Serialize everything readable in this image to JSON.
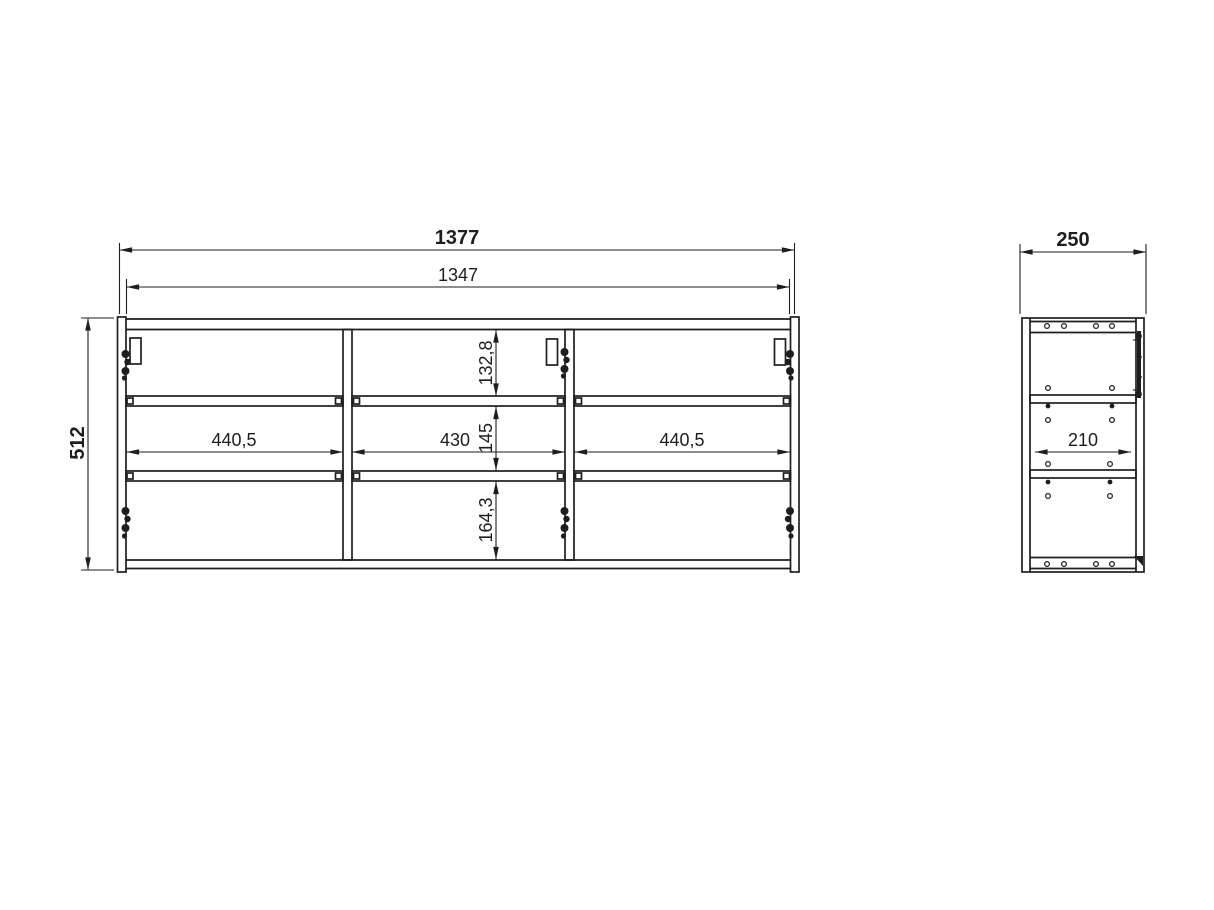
{
  "drawing": {
    "title": "cabinet-dimension-drawing",
    "colors": {
      "line": "#1e1e1e",
      "background": "#ffffff"
    },
    "front_view": {
      "overall_width": "1377",
      "interior_width": "1347",
      "overall_height": "512",
      "compartment_widths": {
        "left": "440,5",
        "center": "430",
        "right": "440,5"
      },
      "compartment_heights": {
        "top": "132,8",
        "middle": "145",
        "bottom": "164,3"
      }
    },
    "side_view": {
      "overall_depth": "250",
      "interior_depth": "210"
    }
  }
}
